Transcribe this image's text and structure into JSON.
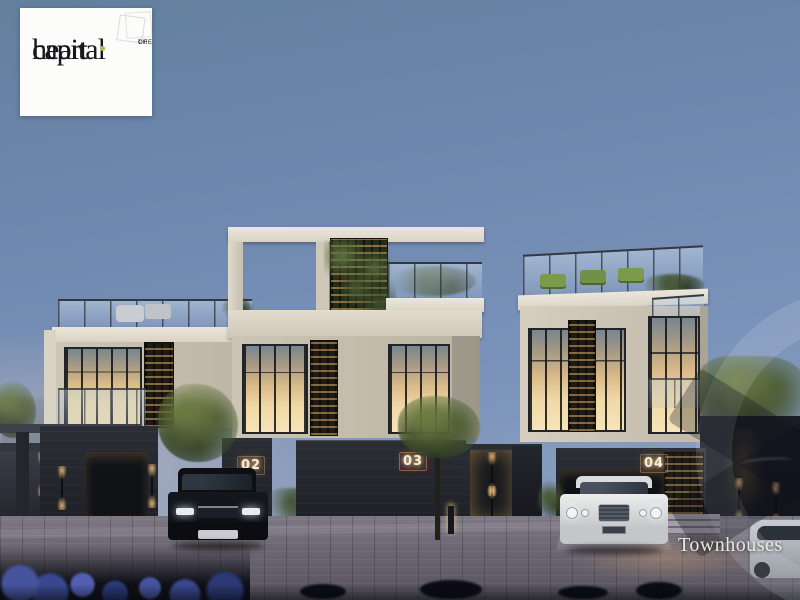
{
  "image_alt": "Twilight architectural rendering of a modern townhouse row with lit windows, rooftop terraces, parked luxury cars and a paved plaza",
  "logo": {
    "word1": "heart",
    "small1": "of",
    "small2": "the",
    "word2": "capital",
    "dot_color": "#9bc053",
    "text_color": "#17171f",
    "card_bg": "#fcfcfb"
  },
  "units": [
    "02",
    "03",
    "04"
  ],
  "caption": {
    "label": "Townhouses",
    "color": "#eae7e1"
  },
  "palette": {
    "sky_top": "#647fa9",
    "sky_horizon": "#a9b6c9",
    "building_cream": "#d6cfc1",
    "dark_stone": "#23262c",
    "window_glow": "#eed39b",
    "lattice_warm": "#e8b870",
    "greenery": "#4c5c31",
    "pavement": "#6c6771",
    "caption_color": "#eae7e1"
  },
  "objects": [
    "developer-logo-card",
    "black-suv",
    "white-luxury-sedan",
    "silver-car-partial",
    "street-trees",
    "wall-sconce-lights",
    "bollard-light",
    "rooftop-terraces",
    "living-green-wall",
    "unit-number-plates",
    "watermark-ring",
    "watermark-x"
  ]
}
